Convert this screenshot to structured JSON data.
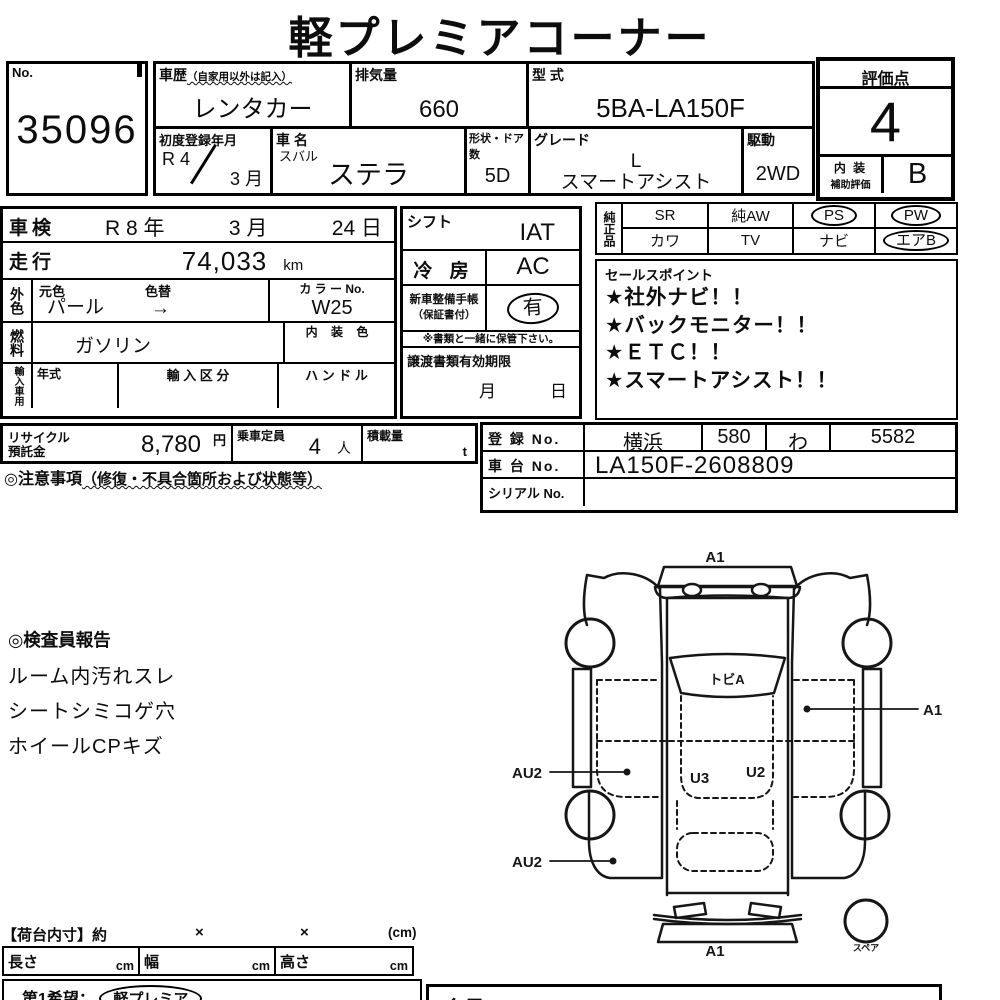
{
  "title": "軽プレミアコーナー",
  "lot": {
    "label": "No.",
    "number": "35096"
  },
  "info": {
    "history": {
      "label": "車歴",
      "note": "（自家用以外は記入）",
      "value": "レンタカー"
    },
    "displacement": {
      "label": "排気量",
      "value": "660"
    },
    "model_code": {
      "label": "型 式",
      "value": "5BA-LA150F"
    },
    "first_reg": {
      "label": "初度登録年月",
      "year": "R 4",
      "month": "3 月"
    },
    "car_name": {
      "label": "車 名",
      "maker": "スバル",
      "value": "ステラ"
    },
    "doors": {
      "label": "形状・ドア数",
      "value": "5D"
    },
    "grade": {
      "label": "グレード",
      "line1": "L",
      "line2": "スマートアシスト"
    },
    "drive": {
      "label": "駆動",
      "value": "2WD"
    }
  },
  "rating": {
    "label": "評価点",
    "score": "4",
    "interior_label1": "内 装",
    "interior_label2": "補助評価",
    "interior_grade": "B"
  },
  "left": {
    "shaken": {
      "label": "車検",
      "year": "R 8 年",
      "month": "3 月",
      "day": "24 日"
    },
    "mileage": {
      "label": "走行",
      "value": "74,033",
      "unit": "km"
    },
    "color": {
      "label": "外色",
      "orig_label": "元色",
      "change_label": "色替",
      "value": "パール",
      "arrow": "→"
    },
    "color_no": {
      "label": "カ ラ ー No.",
      "value": "W25"
    },
    "fuel": {
      "label": "燃料",
      "value": "ガソリン"
    },
    "interior_color": {
      "label": "内 装 色",
      "value": ""
    },
    "import": {
      "label": "輸入車用",
      "year_label": "年式",
      "class_label": "輸 入 区 分",
      "handle_label": "ハ ン ド ル"
    }
  },
  "mid": {
    "shift": {
      "label": "シフト",
      "value": "IAT"
    },
    "ac": {
      "label": "冷 房",
      "value": "AC"
    },
    "manual": {
      "label1": "新車整備手帳",
      "label2": "（保証書付）",
      "value": "有"
    },
    "note": "※書類と一緒に保管下さい。",
    "transfer": {
      "label": "譲渡書類有効期限",
      "month": "月",
      "day": "日"
    }
  },
  "genuine": {
    "label": "純正品",
    "cells": [
      {
        "text": "SR",
        "cls": ""
      },
      {
        "text": "純AW",
        "cls": ""
      },
      {
        "text": "PS",
        "cls": "oval"
      },
      {
        "text": "PW",
        "cls": "oval"
      },
      {
        "text": "カワ",
        "cls": ""
      },
      {
        "text": "TV",
        "cls": ""
      },
      {
        "text": "ナビ",
        "cls": ""
      },
      {
        "text": "エアB",
        "cls": "oval"
      }
    ]
  },
  "sales": {
    "label": "セールスポイント",
    "items": [
      "★社外ナビ！！",
      "★バックモニター！！",
      "★ＥＴＣ！！",
      "★スマートアシスト！！"
    ]
  },
  "recycle": {
    "label1": "リサイクル",
    "label2": "預託金",
    "value": "8,780",
    "unit": "円"
  },
  "capacity": {
    "label": "乗車定員",
    "value": "4",
    "unit": "人"
  },
  "load": {
    "label": "積載量",
    "unit": "t"
  },
  "caution": {
    "heading": "◎注意事項",
    "note": "（修復・不具合箇所および状態等）"
  },
  "registration": {
    "reg": {
      "label": "登 録 No.",
      "area": "横浜",
      "class_no": "580",
      "kana": "わ",
      "number": "5582"
    },
    "chassis": {
      "label": "車 台 No.",
      "value": "LA150F-2608809"
    },
    "serial": {
      "label": "シリアル No.",
      "value": ""
    }
  },
  "inspector": {
    "heading": "◎検査員報告",
    "findings": [
      "ルーム内汚れスレ",
      "シートシミコゲ穴",
      "ホイールCPキズ"
    ]
  },
  "diagram": {
    "front_label": "A1",
    "windshield_label": "トビA",
    "right_door_label": "A1",
    "left_front_label": "AU2",
    "floor_left_label": "U3",
    "floor_right_label": "U2",
    "left_rear_label": "AU2",
    "rear_label": "A1",
    "spare_label": "スペア"
  },
  "cargo": {
    "heading": "【荷台内寸】約",
    "x1": "×",
    "x2": "×",
    "unit_note": "(cm)",
    "length_label": "長さ",
    "width_label": "幅",
    "height_label": "高さ",
    "unit": "cm",
    "wish_label": "第1希望：",
    "wish_value": "軽プレミア"
  },
  "member": {
    "label": "会員No.",
    "value": "Y-0712"
  }
}
